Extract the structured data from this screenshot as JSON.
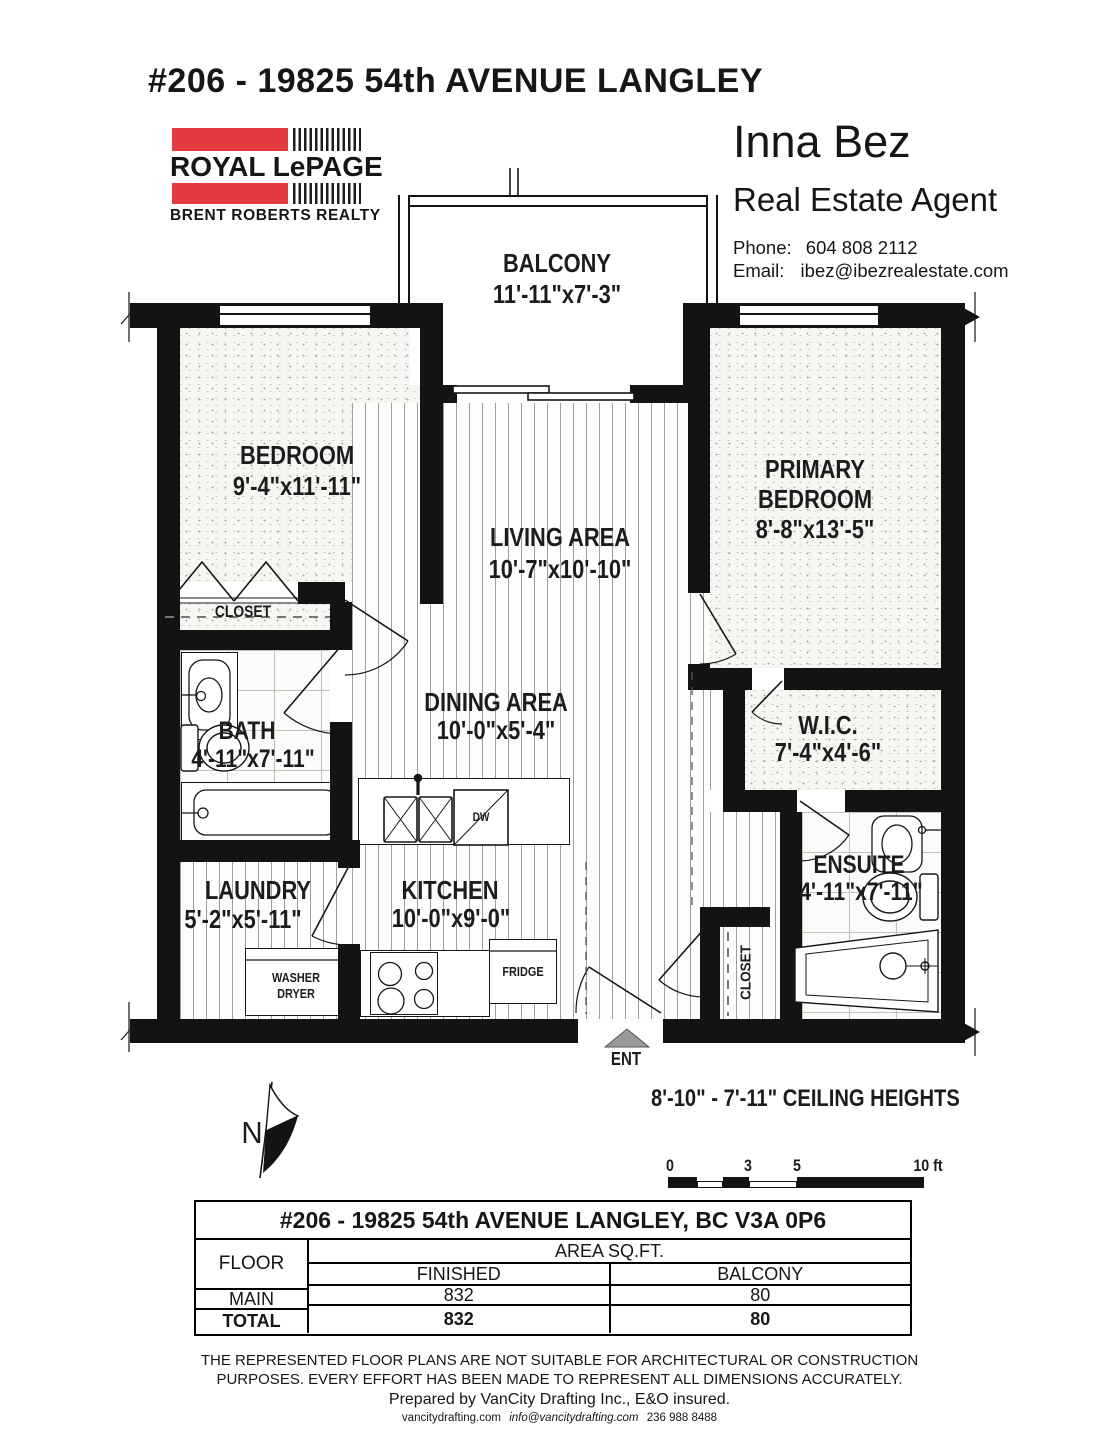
{
  "header": {
    "title": "#206 - 19825 54th AVENUE LANGLEY"
  },
  "brand": {
    "name": "ROYAL LePAGE",
    "sub": "BRENT ROBERTS REALTY",
    "accent_color": "#e23b40"
  },
  "agent": {
    "name": "Inna Bez",
    "role": "Real Estate Agent",
    "phone_label": "Phone:",
    "phone": "604 808 2112",
    "email_label": "Email:",
    "email": "ibez@ibezrealestate.com"
  },
  "plan": {
    "balcony": {
      "label": "BALCONY",
      "dims": "11'-11\"x7'-3\""
    },
    "bedroom": {
      "label": "BEDROOM",
      "dims": "9'-4\"x11'-11\""
    },
    "living_area": {
      "label": "LIVING AREA",
      "dims": "10'-7\"x10'-10\""
    },
    "primary_bedroom": {
      "label1": "PRIMARY",
      "label2": "BEDROOM",
      "dims": "8'-8\"x13'-5\""
    },
    "bedroom_closet": {
      "label": "CLOSET"
    },
    "bath": {
      "label": "BATH",
      "dims": "4'-11\"x7'-11\""
    },
    "dining_area": {
      "label": "DINING AREA",
      "dims": "10'-0\"x5'-4\""
    },
    "wic": {
      "label": "W.I.C.",
      "dims": "7'-4\"x4'-6\""
    },
    "laundry": {
      "label": "LAUNDRY",
      "dims": "5'-2\"x5'-11\""
    },
    "kitchen": {
      "label": "KITCHEN",
      "dims": "10'-0\"x9'-0\""
    },
    "ensuite": {
      "label": "ENSUITE",
      "dims": "4'-11\"x7'-11\""
    },
    "entry_closet": {
      "label": "CLOSET"
    },
    "appliances": {
      "washer_line1": "WASHER",
      "washer_line2": "DRYER",
      "fridge": "FRIDGE",
      "dishwasher": "DW"
    },
    "entry": {
      "label": "ENT"
    },
    "compass": {
      "label": "N"
    },
    "ceiling_note": "8'-10\" - 7'-11\" CEILING HEIGHTS",
    "scale_bar": {
      "ticks": [
        "0",
        "3",
        "5",
        "10 ft"
      ]
    }
  },
  "area_table": {
    "title": "#206 - 19825 54th AVENUE LANGLEY, BC V3A 0P6",
    "floor_header": "FLOOR",
    "area_header": "AREA SQ.FT.",
    "col_finished": "FINISHED",
    "col_balcony": "BALCONY",
    "rows": [
      {
        "floor": "MAIN",
        "finished": "832",
        "balcony": "80"
      },
      {
        "floor": "TOTAL",
        "finished": "832",
        "balcony": "80"
      }
    ]
  },
  "footer": {
    "disclaimer_line1": "THE REPRESENTED FLOOR PLANS ARE NOT SUITABLE FOR ARCHITECTURAL OR CONSTRUCTION",
    "disclaimer_line2": "PURPOSES. EVERY EFFORT HAS BEEN MADE TO REPRESENT ALL DIMENSIONS ACCURATELY.",
    "prepared_by": "Prepared by VanCity Drafting Inc., E&O insured.",
    "contact_site": "vancitydrafting.com",
    "contact_email": "info@vancitydrafting.com",
    "contact_phone": "236 988 8488"
  }
}
